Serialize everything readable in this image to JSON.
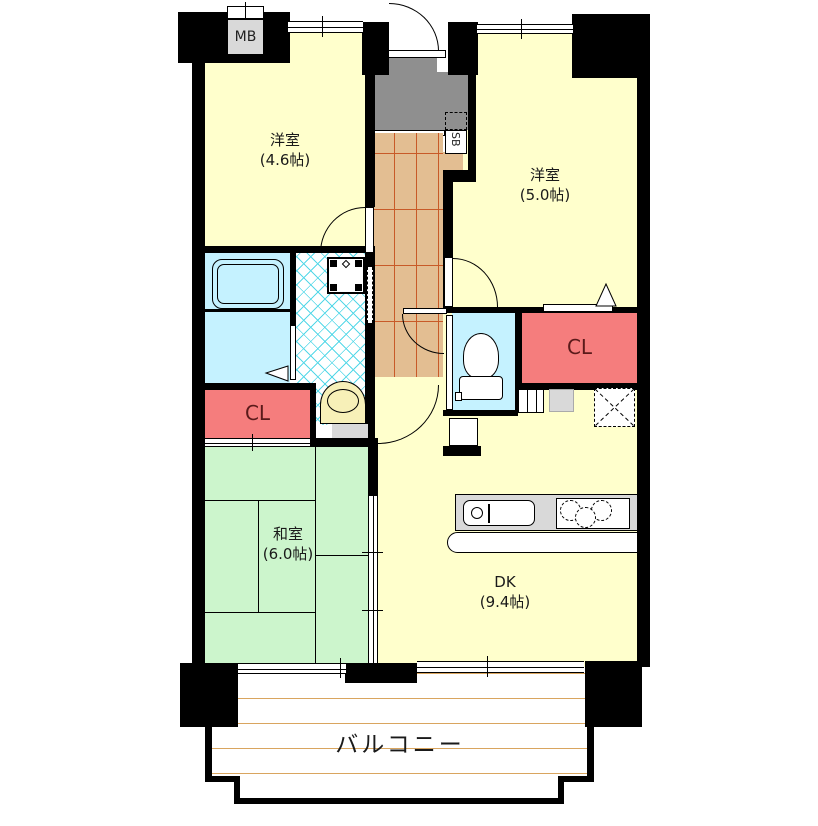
{
  "plan_type": "apartment-floor-plan",
  "rooms": {
    "western1": {
      "name": "洋室",
      "size": "(4.6帖)"
    },
    "western2": {
      "name": "洋室",
      "size": "(5.0帖)"
    },
    "japanese": {
      "name": "和室",
      "size": "(6.0帖)"
    },
    "dk": {
      "name": "DK",
      "size": "(9.4帖)"
    },
    "balcony": {
      "name": "バルコニー"
    }
  },
  "fixtures": {
    "meter_box": "MB",
    "shoe_box": "SB",
    "closet_left": "CL",
    "closet_right": "CL"
  },
  "colors": {
    "wall": "#000000",
    "western_room": "#FFFFCC",
    "japanese_room": "#CCF5CC",
    "wet_area": "#C5F2FF",
    "closet": "#F57D7D",
    "hall_flooring": "#E3BE92",
    "flooring_line": "#C85A28",
    "entrance": "#8F8F8F",
    "counter_gray": "#D9D9D9",
    "balcony_line": "#D9A55F",
    "lattice_line": "#55D8E8"
  }
}
